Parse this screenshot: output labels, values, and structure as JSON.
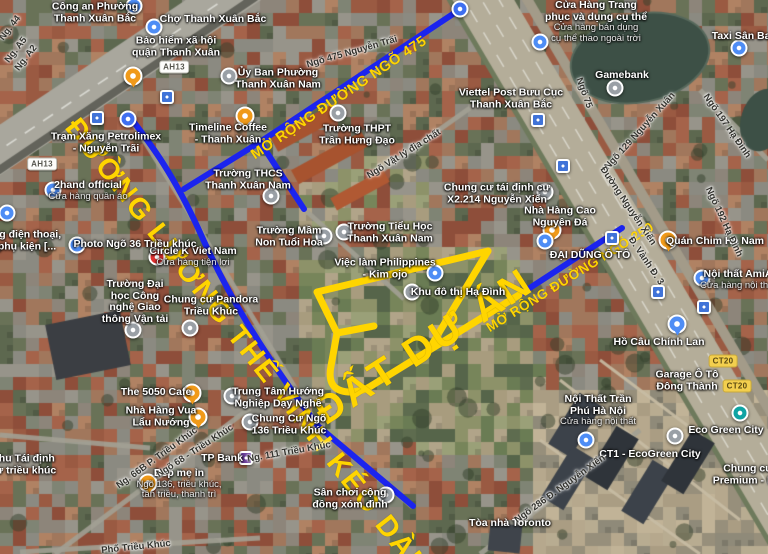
{
  "annotations": {
    "project_area_label": "ĐẤT DỰ ÁN",
    "road_ltv_label": "ĐƯỜNG LƯƠNG THẾ VINH KÉO DÀI",
    "road_475_label": "MỞ RỘNG ĐƯỜNG NGÕ 475",
    "road_250_label": "MỞ RỘNG ĐƯỜNG NGÕ 250",
    "highlight_color": "#FFD500",
    "route_line_color": "#1B24EE"
  },
  "route_badges": [
    {
      "text": "AH13",
      "x": 174,
      "y": 67,
      "style": "white"
    },
    {
      "text": "AH13",
      "x": 42,
      "y": 164,
      "style": "white"
    },
    {
      "text": "CT20",
      "x": 723,
      "y": 361,
      "style": "yellow"
    },
    {
      "text": "CT20",
      "x": 737,
      "y": 386,
      "style": "yellow"
    }
  ],
  "pois": [
    {
      "x": 95,
      "y": 13,
      "lines": [
        "Công an Phường",
        "Thanh Xuân Bắc"
      ]
    },
    {
      "x": 213,
      "y": 20,
      "lines": [
        "Chợ Thanh Xuân Bắc"
      ]
    },
    {
      "x": 176,
      "y": 47,
      "lines": [
        "Bảo hiểm xã hội",
        "quận Thanh Xuân"
      ]
    },
    {
      "x": 106,
      "y": 143,
      "lines": [
        "Trạm Xăng Petrolimex",
        "- Nguyễn Trãi"
      ]
    },
    {
      "x": 228,
      "y": 134,
      "lines": [
        "Timeline Coffee",
        "- Thanh Xuân"
      ]
    },
    {
      "x": 278,
      "y": 79,
      "lines": [
        "Ủy Ban Phường",
        "Thanh Xuân Nam"
      ]
    },
    {
      "x": 357,
      "y": 135,
      "lines": [
        "Trường THPT",
        "Trần Hưng Đạo"
      ]
    },
    {
      "x": 248,
      "y": 180,
      "lines": [
        "Trường THCS",
        "Thanh Xuân Nam"
      ]
    },
    {
      "x": 289,
      "y": 237,
      "lines": [
        "Trường Mầm",
        "Non Tuổi Hoa"
      ]
    },
    {
      "x": 390,
      "y": 233,
      "lines": [
        "Trường Tiểu Học",
        "Thanh Xuân Nam"
      ]
    },
    {
      "x": 385,
      "y": 269,
      "lines": [
        "Việc làm Philippines",
        "- Kim ojo"
      ]
    },
    {
      "x": 458,
      "y": 293,
      "lines": [
        "Khu đô thị Hạ Đình"
      ]
    },
    {
      "x": 497,
      "y": 194,
      "lines": [
        "Chung cư tái định cư",
        "X2.214 Nguyễn Xiển"
      ]
    },
    {
      "x": 560,
      "y": 217,
      "lines": [
        "Nhà Hàng Cao",
        "Nguyên Đá"
      ]
    },
    {
      "x": 590,
      "y": 256,
      "lines": [
        "ĐẠI DŨNG Ô TÔ"
      ]
    },
    {
      "x": 715,
      "y": 242,
      "lines": [
        "Quán Chim Hà Nam"
      ]
    },
    {
      "x": 738,
      "y": 280,
      "lines": [
        "Nội thất AmiA"
      ],
      "sub": [
        "Cửa hàng nội thất"
      ]
    },
    {
      "x": 659,
      "y": 343,
      "lines": [
        "Hồ Câu Chính Lan"
      ]
    },
    {
      "x": 687,
      "y": 381,
      "lines": [
        "Garage Ô Tô",
        "Đông Thành"
      ]
    },
    {
      "x": 598,
      "y": 411,
      "lines": [
        "Nội Thất Trần",
        "Phú Hà Nội"
      ],
      "sub": [
        "Cửa hàng nội thất"
      ]
    },
    {
      "x": 650,
      "y": 455,
      "lines": [
        "CT1 - EcoGreen City"
      ]
    },
    {
      "x": 726,
      "y": 431,
      "lines": [
        "Eco Green City"
      ]
    },
    {
      "x": 748,
      "y": 475,
      "lines": [
        "Chung cư",
        "Premium - N..."
      ]
    },
    {
      "x": 510,
      "y": 524,
      "lines": [
        "Tòa nhà Toronto"
      ]
    },
    {
      "x": 156,
      "y": 393,
      "lines": [
        "The 5050 Cafe"
      ]
    },
    {
      "x": 161,
      "y": 417,
      "lines": [
        "Nhà Hàng Vua",
        "Lẩu Nướng"
      ]
    },
    {
      "x": 222,
      "y": 459,
      "lines": [
        "TP Bank"
      ]
    },
    {
      "x": 179,
      "y": 484,
      "lines": [
        "Bếp mẹ ỉn"
      ],
      "sub": [
        "Ngõ 136, triều khúc,",
        "tân triều, thanh trì"
      ]
    },
    {
      "x": 23,
      "y": 465,
      "lines": [
        "Khu Tái định",
        "cư triều khúc"
      ]
    },
    {
      "x": 278,
      "y": 398,
      "lines": [
        "Trung Tâm Hướng",
        "Nghiệp Dạy Nghề"
      ]
    },
    {
      "x": 289,
      "y": 425,
      "lines": [
        "Chung Cư Ngõ",
        "136 Triều Khúc"
      ]
    },
    {
      "x": 350,
      "y": 499,
      "lines": [
        "Sân chơi cộng",
        "đồng xóm đình"
      ]
    },
    {
      "x": 211,
      "y": 306,
      "lines": [
        "Chung cư Pandora",
        "Triều Khúc"
      ]
    },
    {
      "x": 135,
      "y": 302,
      "lines": [
        "Trường Đại",
        "học Công",
        "nghệ Giao",
        "thông Vận tải"
      ]
    },
    {
      "x": 193,
      "y": 257,
      "lines": [
        "Circle K Viet Nam"
      ],
      "sub": [
        "Cửa hàng tiện lợi"
      ]
    },
    {
      "x": 135,
      "y": 245,
      "lines": [
        "Photo Ngõ 36 Triều khúc"
      ]
    },
    {
      "x": 88,
      "y": 191,
      "lines": [
        "2hand official"
      ],
      "sub": [
        "Cửa hàng quần áo"
      ]
    },
    {
      "x": 27,
      "y": 241,
      "lines": [
        "ng điện thoại,",
        "phụ kiện [..."
      ]
    },
    {
      "x": 596,
      "y": 22,
      "lines": [
        "Cửa Hàng Trang",
        "phục và dụng cụ thể"
      ],
      "sub": [
        "Cửa hàng bán dụng",
        "cụ thể thao ngoài trời"
      ]
    },
    {
      "x": 622,
      "y": 76,
      "lines": [
        "Gamebank"
      ]
    },
    {
      "x": 744,
      "y": 37,
      "lines": [
        "Taxi Sân Bay"
      ]
    },
    {
      "x": 511,
      "y": 99,
      "lines": [
        "Viettel Post Bưu Cục",
        "Thanh Xuân Bắc"
      ]
    }
  ],
  "street_labels": [
    {
      "text": "Ngõ 475 Nguyễn Trãi",
      "x": 352,
      "y": 52,
      "rot": -16
    },
    {
      "text": "Ngõ Vật lý địa chất",
      "x": 404,
      "y": 154,
      "rot": -32
    },
    {
      "text": "Ngõ 75",
      "x": 584,
      "y": 93,
      "rot": 70
    },
    {
      "text": "Ngõ 129 Nguyễn Xuân",
      "x": 640,
      "y": 131,
      "rot": -48
    },
    {
      "text": "Ngõ 197 Hạ Đình",
      "x": 727,
      "y": 126,
      "rot": 55
    },
    {
      "text": "Ngõ 192 Hạ Đình",
      "x": 724,
      "y": 222,
      "rot": 65
    },
    {
      "text": "Đường Nguyễn Xiển",
      "x": 628,
      "y": 206,
      "rot": 56
    },
    {
      "text": "Đ. Vành Đ. 3",
      "x": 646,
      "y": 261,
      "rot": 56
    },
    {
      "text": "Phố Triều Khúc",
      "x": 136,
      "y": 547,
      "rot": -6
    },
    {
      "text": "Ng. 66B P. Triều Khúc",
      "x": 157,
      "y": 458,
      "rot": -36
    },
    {
      "text": "Ngõ 68 - Triều Khúc",
      "x": 195,
      "y": 451,
      "rot": -33
    },
    {
      "text": "Ng. 111 Triều Khúc",
      "x": 289,
      "y": 452,
      "rot": -10
    },
    {
      "text": "Ngõ 286 Đ. Nguyễn Xiển",
      "x": 560,
      "y": 489,
      "rot": -36
    },
    {
      "text": "Ng. 44",
      "x": 10,
      "y": 28,
      "rot": -52
    },
    {
      "text": "Ng. A5",
      "x": 16,
      "y": 50,
      "rot": -52
    },
    {
      "text": "Ng. A2",
      "x": 26,
      "y": 58,
      "rot": -52
    }
  ],
  "markers": [
    {
      "x": 134,
      "y": 6,
      "color": "#4e8df5",
      "shape": "c"
    },
    {
      "x": 154,
      "y": 27,
      "color": "#4e8df5",
      "shape": "c"
    },
    {
      "x": 133,
      "y": 76,
      "color": "#f09a1a",
      "shape": "p"
    },
    {
      "x": 97,
      "y": 118,
      "color": "#4073d8",
      "shape": "s"
    },
    {
      "x": 167,
      "y": 97,
      "color": "#4073d8",
      "shape": "s"
    },
    {
      "x": 128,
      "y": 119,
      "color": "#3f6ff0",
      "shape": "c"
    },
    {
      "x": 245,
      "y": 116,
      "color": "#f09a1a",
      "shape": "p"
    },
    {
      "x": 229,
      "y": 76,
      "color": "#9aa0a6",
      "shape": "c"
    },
    {
      "x": 338,
      "y": 113,
      "color": "#9aa0a6",
      "shape": "c"
    },
    {
      "x": 271,
      "y": 196,
      "color": "#9aa0a6",
      "shape": "c"
    },
    {
      "x": 324,
      "y": 236,
      "color": "#9aa0a6",
      "shape": "c"
    },
    {
      "x": 344,
      "y": 232,
      "color": "#9aa0a6",
      "shape": "c"
    },
    {
      "x": 435,
      "y": 273,
      "color": "#4e8df5",
      "shape": "c"
    },
    {
      "x": 412,
      "y": 292,
      "color": "#9aa0a6",
      "shape": "c"
    },
    {
      "x": 545,
      "y": 192,
      "color": "#9aa0a6",
      "shape": "c"
    },
    {
      "x": 552,
      "y": 230,
      "color": "#f09a1a",
      "shape": "p"
    },
    {
      "x": 545,
      "y": 241,
      "color": "#4e8df5",
      "shape": "c"
    },
    {
      "x": 668,
      "y": 240,
      "color": "#f09a1a",
      "shape": "p"
    },
    {
      "x": 702,
      "y": 278,
      "color": "#4e8df5",
      "shape": "c"
    },
    {
      "x": 677,
      "y": 324,
      "color": "#4e8df5",
      "shape": "p"
    },
    {
      "x": 586,
      "y": 440,
      "color": "#4e8df5",
      "shape": "c"
    },
    {
      "x": 675,
      "y": 436,
      "color": "#9aa0a6",
      "shape": "c"
    },
    {
      "x": 740,
      "y": 413,
      "color": "#0fa3a3",
      "shape": "c"
    },
    {
      "x": 192,
      "y": 393,
      "color": "#f09a1a",
      "shape": "p"
    },
    {
      "x": 198,
      "y": 417,
      "color": "#f09a1a",
      "shape": "p"
    },
    {
      "x": 148,
      "y": 483,
      "color": "#f09a1a",
      "shape": "p"
    },
    {
      "x": 246,
      "y": 458,
      "color": "#6a3d9a",
      "shape": "s"
    },
    {
      "x": 232,
      "y": 396,
      "color": "#9aa0a6",
      "shape": "c"
    },
    {
      "x": 250,
      "y": 422,
      "color": "#9aa0a6",
      "shape": "c"
    },
    {
      "x": 386,
      "y": 495,
      "color": "#9aa0a6",
      "shape": "c"
    },
    {
      "x": 190,
      "y": 328,
      "color": "#9aa0a6",
      "shape": "c"
    },
    {
      "x": 133,
      "y": 330,
      "color": "#9aa0a6",
      "shape": "c"
    },
    {
      "x": 157,
      "y": 257,
      "color": "#e03131",
      "shape": "c"
    },
    {
      "x": 77,
      "y": 245,
      "color": "#4e8df5",
      "shape": "c"
    },
    {
      "x": 53,
      "y": 190,
      "color": "#4e8df5",
      "shape": "c"
    },
    {
      "x": 7,
      "y": 213,
      "color": "#4e8df5",
      "shape": "c"
    },
    {
      "x": 540,
      "y": 42,
      "color": "#4e8df5",
      "shape": "c"
    },
    {
      "x": 615,
      "y": 88,
      "color": "#9aa0a6",
      "shape": "c"
    },
    {
      "x": 739,
      "y": 48,
      "color": "#4e8df5",
      "shape": "c"
    },
    {
      "x": 538,
      "y": 120,
      "color": "#4073d8",
      "shape": "s"
    },
    {
      "x": 563,
      "y": 166,
      "color": "#4073d8",
      "shape": "s"
    },
    {
      "x": 612,
      "y": 238,
      "color": "#4073d8",
      "shape": "s"
    },
    {
      "x": 658,
      "y": 292,
      "color": "#4073d8",
      "shape": "s"
    },
    {
      "x": 704,
      "y": 307,
      "color": "#4073d8",
      "shape": "s"
    },
    {
      "x": 460,
      "y": 9,
      "color": "#3f6ff0",
      "shape": "c"
    }
  ]
}
